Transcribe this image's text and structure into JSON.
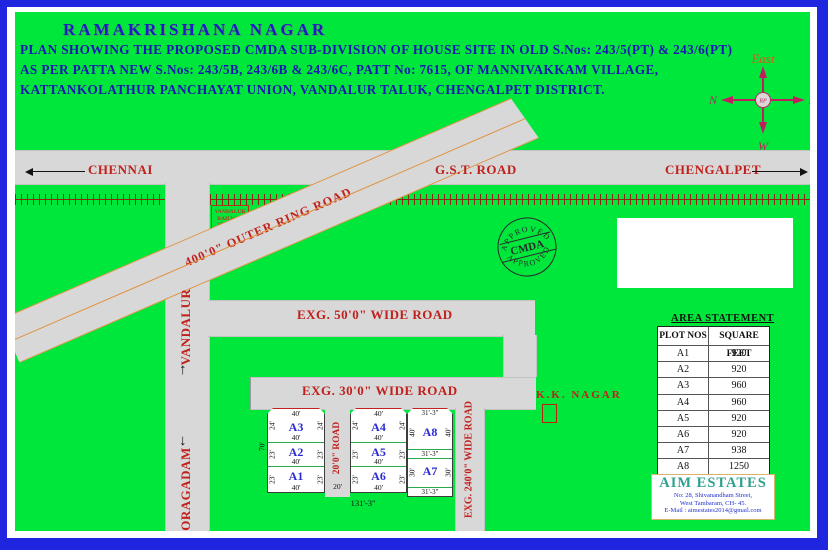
{
  "header": {
    "title": "RAMAKRISHANA NAGAR",
    "line1": "PLAN SHOWING THE PROPOSED CMDA SUB-DIVISION OF HOUSE SITE IN OLD S.Nos: 243/5(PT) & 243/6(PT)",
    "line2": "AS PER PATTA NEW S.Nos: 243/5B, 243/6B & 243/6C, PATT No: 7615, OF MANNIVAKKAM VILLAGE,",
    "line3": "KATTANKOLATHUR PANCHAYAT UNION, VANDALUR TALUK, CHENGALPET DISTRICT."
  },
  "compass": {
    "east": "East",
    "n": "N",
    "s": "S",
    "w": "W",
    "center": "RP"
  },
  "gst": {
    "label": "G.S.T. ROAD",
    "left_city": "CHENNAI",
    "right_city": "CHENGALPET"
  },
  "ring_road": {
    "label": "400'0\" OUTER RING ROAD"
  },
  "station": {
    "line1": "VANDALUR",
    "line2": "RAILWAY",
    "line3": "STATION"
  },
  "roads": {
    "wide50": "EXG. 50'0\" WIDE ROAD",
    "wide30": "EXG. 30'0\" WIDE ROAD",
    "wide240": "EXG. 240'0\" WIDE ROAD",
    "road20": "20'0\" ROAD",
    "road20_dim": "20'",
    "vandalur": "VANDALUR",
    "oragadam": "ORAGADAM"
  },
  "kk_nagar": {
    "label": "K.K. NAGAR"
  },
  "stamp": {
    "top": "APPROVED",
    "center": "CMDA",
    "bottom": "APPROVED"
  },
  "plot_block": {
    "left_total": "70'",
    "bottom_total": "131'-3\"",
    "a3": {
      "label": "A3",
      "top": "40'",
      "bottom": "40'",
      "left": "24'",
      "right": "24'"
    },
    "a2": {
      "label": "A2",
      "bottom": "40'",
      "left": "23'",
      "right": "23'"
    },
    "a1": {
      "label": "A1",
      "bottom": "40'",
      "left": "23'",
      "right": "23'"
    },
    "a4": {
      "label": "A4",
      "top": "40'",
      "bottom": "40'",
      "left": "24'",
      "right": "24'"
    },
    "a5": {
      "label": "A5",
      "bottom": "40'",
      "left": "23'",
      "right": "23'"
    },
    "a6": {
      "label": "A6",
      "bottom": "40'",
      "left": "23'",
      "right": "23'"
    },
    "a8": {
      "label": "A8",
      "top": "31'-3\"",
      "left": "40'",
      "right": "40'"
    },
    "mid78": "31'-3\"",
    "a7": {
      "label": "A7",
      "left": "30'",
      "right": "30'",
      "bottom": "31'-3\""
    }
  },
  "area_statement": {
    "title": "AREA STATEMENT",
    "columns": [
      "PLOT NOS",
      "SQUARE FEET"
    ],
    "rows": [
      [
        "A1",
        "920"
      ],
      [
        "A2",
        "920"
      ],
      [
        "A3",
        "960"
      ],
      [
        "A4",
        "960"
      ],
      [
        "A5",
        "920"
      ],
      [
        "A6",
        "920"
      ],
      [
        "A7",
        "938"
      ],
      [
        "A8",
        "1250"
      ]
    ]
  },
  "company": {
    "name": "AIM ESTATES",
    "address1": "No: 28, Shivanandham Street,",
    "address2": "West Tambaram, CH- 45.",
    "address3": "E-Mail : aimestates2014@gmail.com"
  },
  "colors": {
    "frame_blue": "#2026df",
    "green": "#00e73c",
    "road_gray": "#d8d8d8",
    "label_red": "#c0211c",
    "heading_blue": "#1a18b0",
    "plot_blue": "#2b2bd4",
    "ring_orange": "#e0913c",
    "railway_brown": "#8f2413",
    "company_teal": "#2fa190"
  }
}
